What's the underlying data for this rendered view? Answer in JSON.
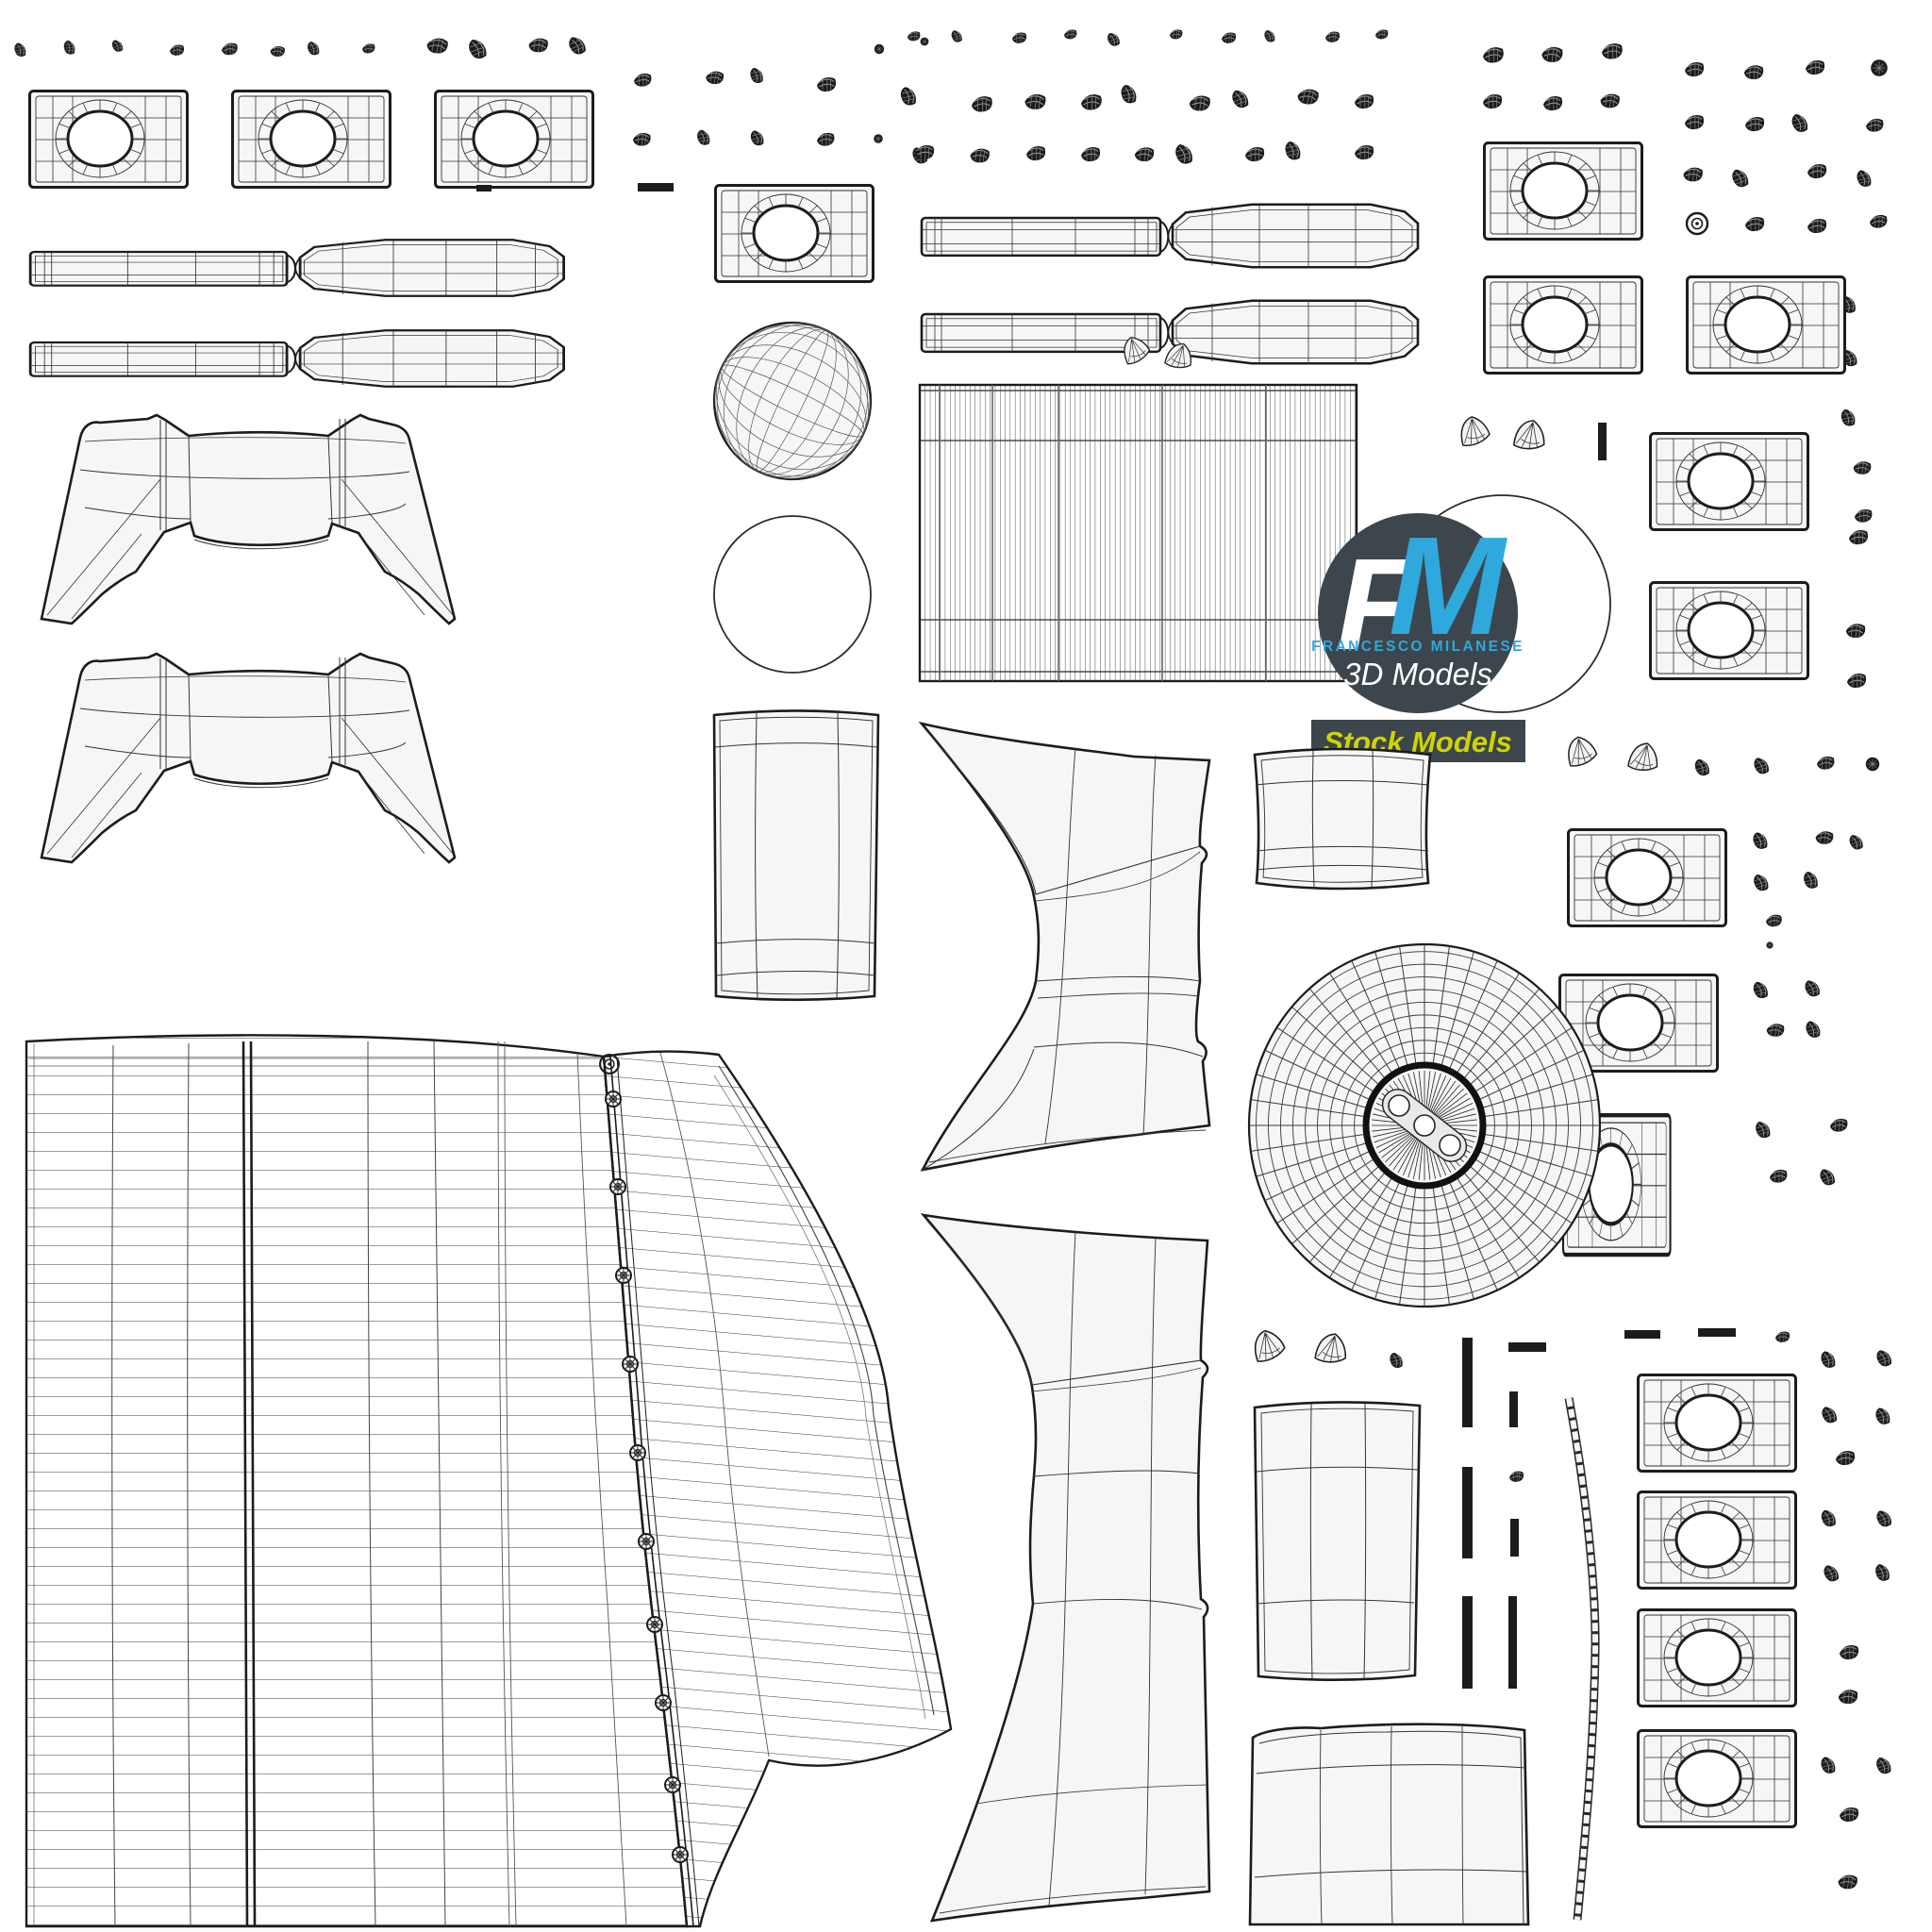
{
  "document": {
    "kind": "uv-wireframe-texture-sheet",
    "background": "#ffffff"
  },
  "logo": {
    "monogram_f": "F",
    "monogram_m": "M",
    "name_line": "FRANCESCO MILANESE",
    "tagline": "3D Models",
    "badge_label": "Stock Models"
  },
  "colors": {
    "accent-blue": "#2fa8dc",
    "badge-yellow": "#cfd400",
    "logo-dark": "#3c464c",
    "line": "#2b2b2b",
    "panel": "#f6f6f6"
  }
}
